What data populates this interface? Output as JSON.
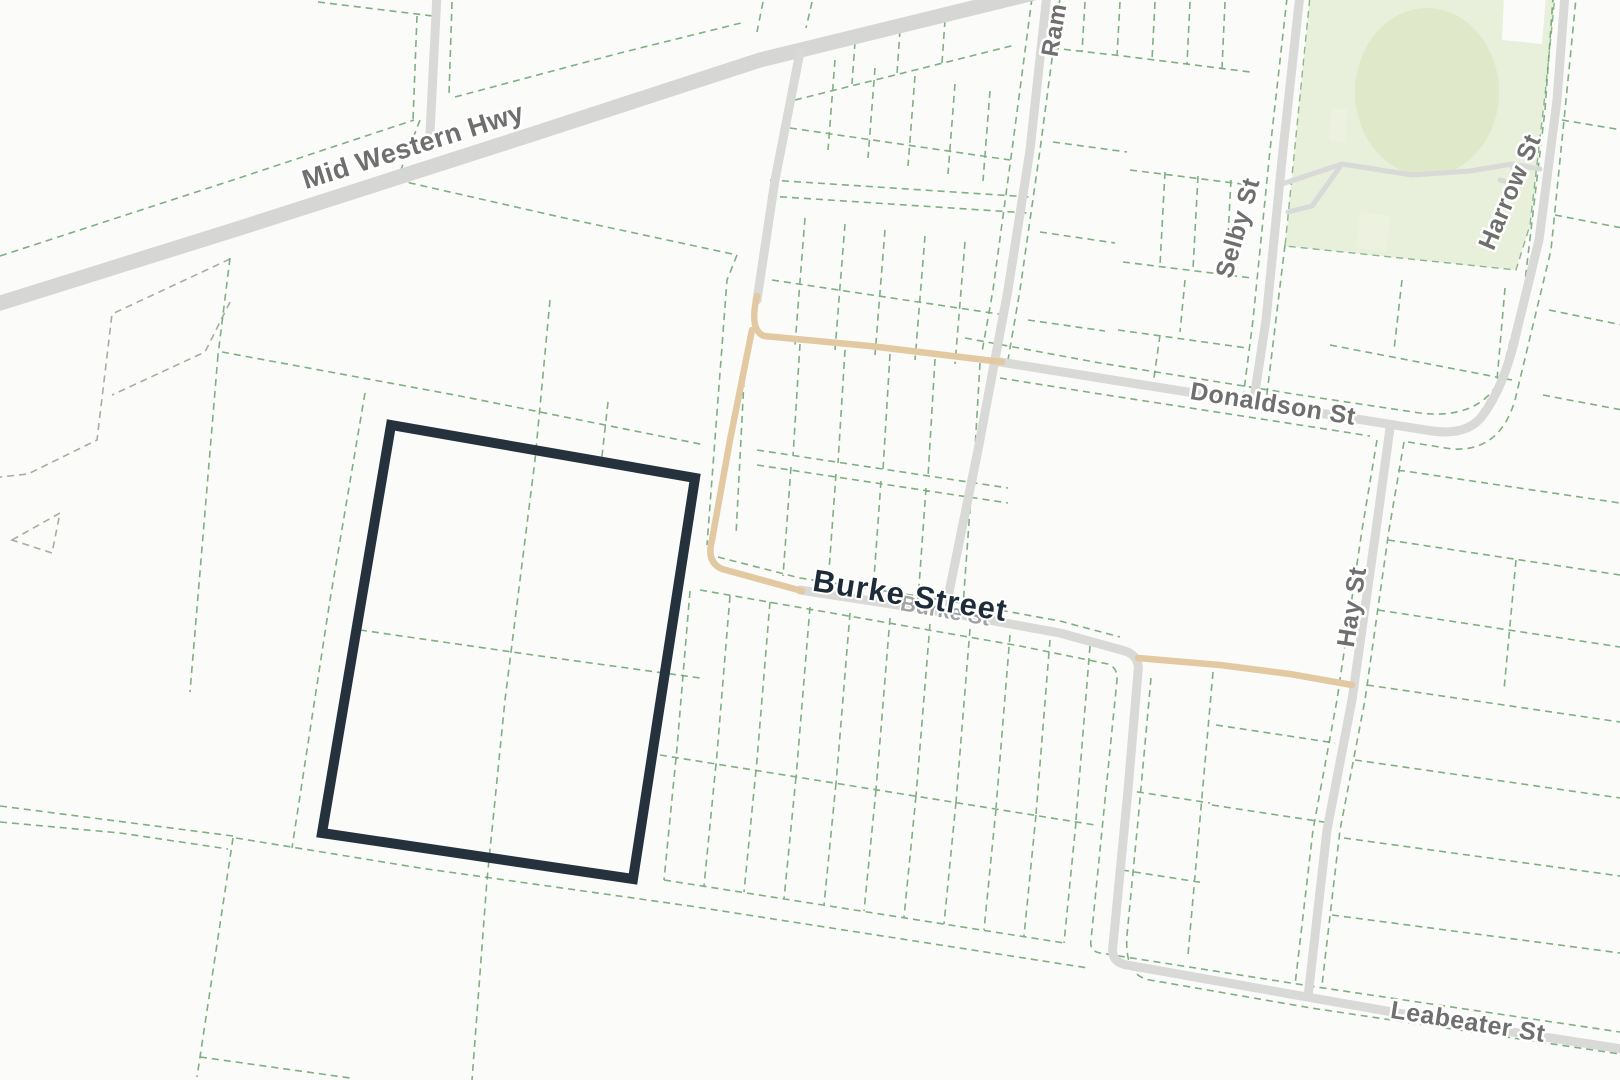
{
  "map": {
    "type": "street-cadastral-map",
    "labels": {
      "mid_western_hwy": "Mid Western Hwy",
      "ram": "Ram",
      "selby": "Selby St",
      "harrow": "Harrow St",
      "donaldson": "Donaldson St",
      "burke_main": "Burke Street",
      "burke_faded": "Burke St",
      "hay": "Hay St",
      "leabeater": "Leabeater St"
    },
    "colors": {
      "background": "#fbfbf9",
      "road": "#d9d9d7",
      "road_highway": "#d6d6d4",
      "road_unsealed": "#e2c9a2",
      "parcel_line": "#5f9e66",
      "terrain_line": "#9aa695",
      "park_fill": "#e8efda",
      "park_oval": "#dfe9ca",
      "park_patch": "#edf2e0",
      "highlight_stroke": "#26313e",
      "label_gray": "#6f6f6f",
      "label_faded": "#a3a3a3",
      "label_dark": "#1e2b38"
    }
  }
}
